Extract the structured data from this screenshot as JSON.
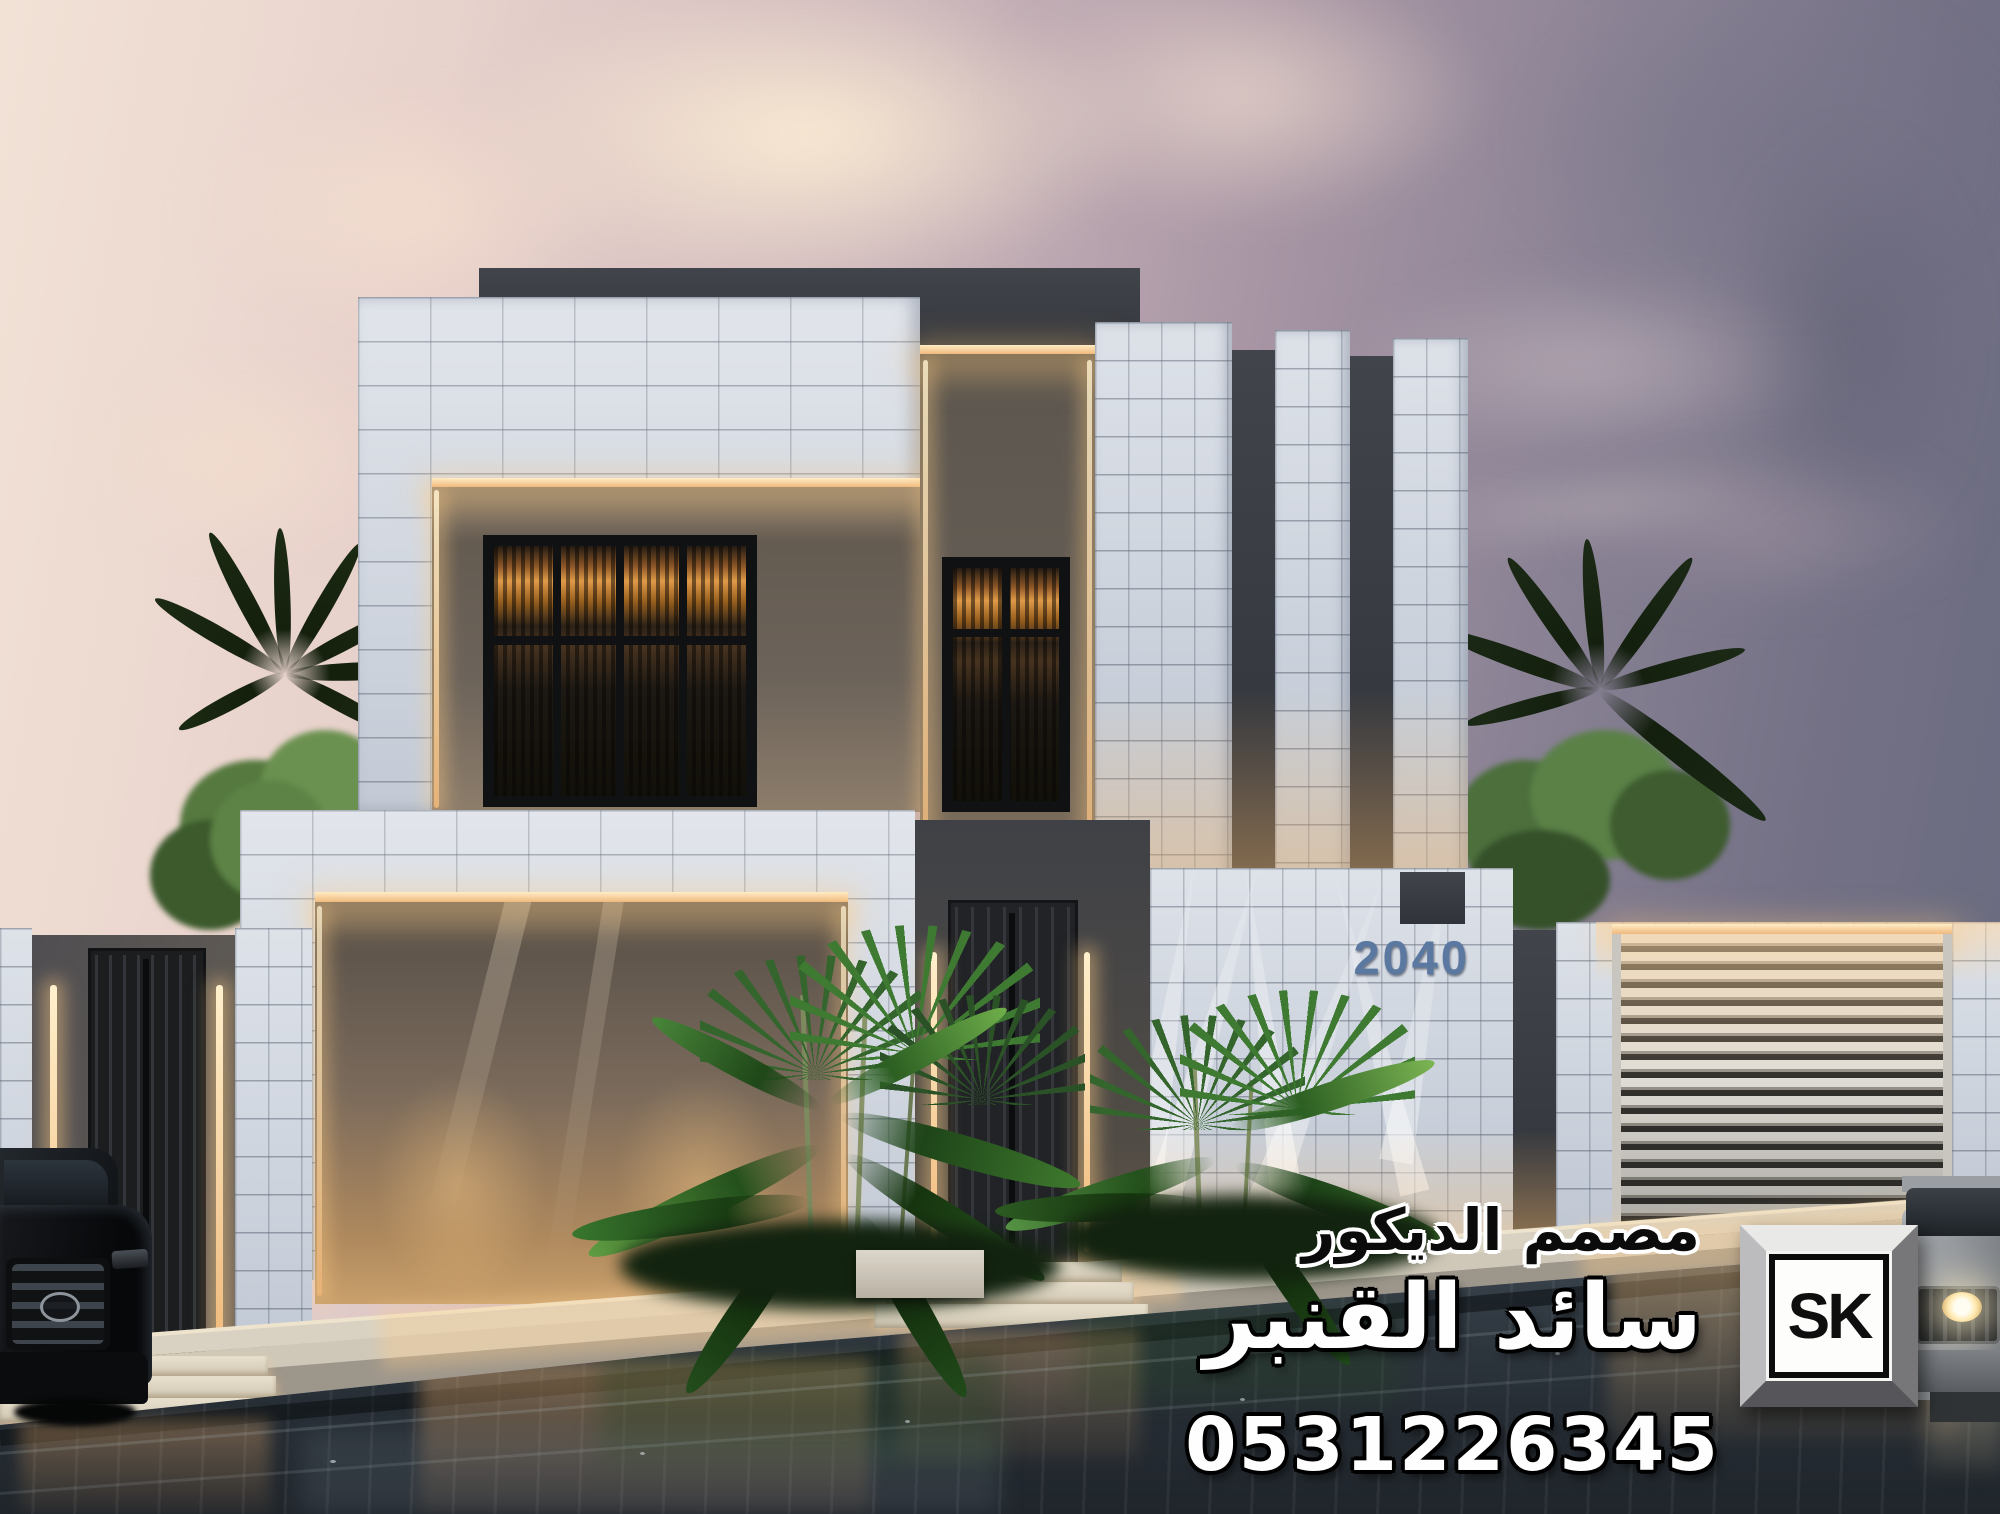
{
  "villa": {
    "house_number": "2040"
  },
  "watermark": {
    "title_ar": "مصمم الديكور",
    "name_ar": "سائد القنبر",
    "phone": "0531226345",
    "logo_text": "SK"
  },
  "colors": {
    "sky_warm": "#f2e2d6",
    "sky_cool": "#666a7e",
    "tile_white": "#d8dde5",
    "charcoal_accent": "#35383e",
    "warm_light": "#ffd9a0",
    "foliage_green": "#3f6b35",
    "wet_asphalt": "#2b333b",
    "house_number_blue": "#5b79a0"
  }
}
